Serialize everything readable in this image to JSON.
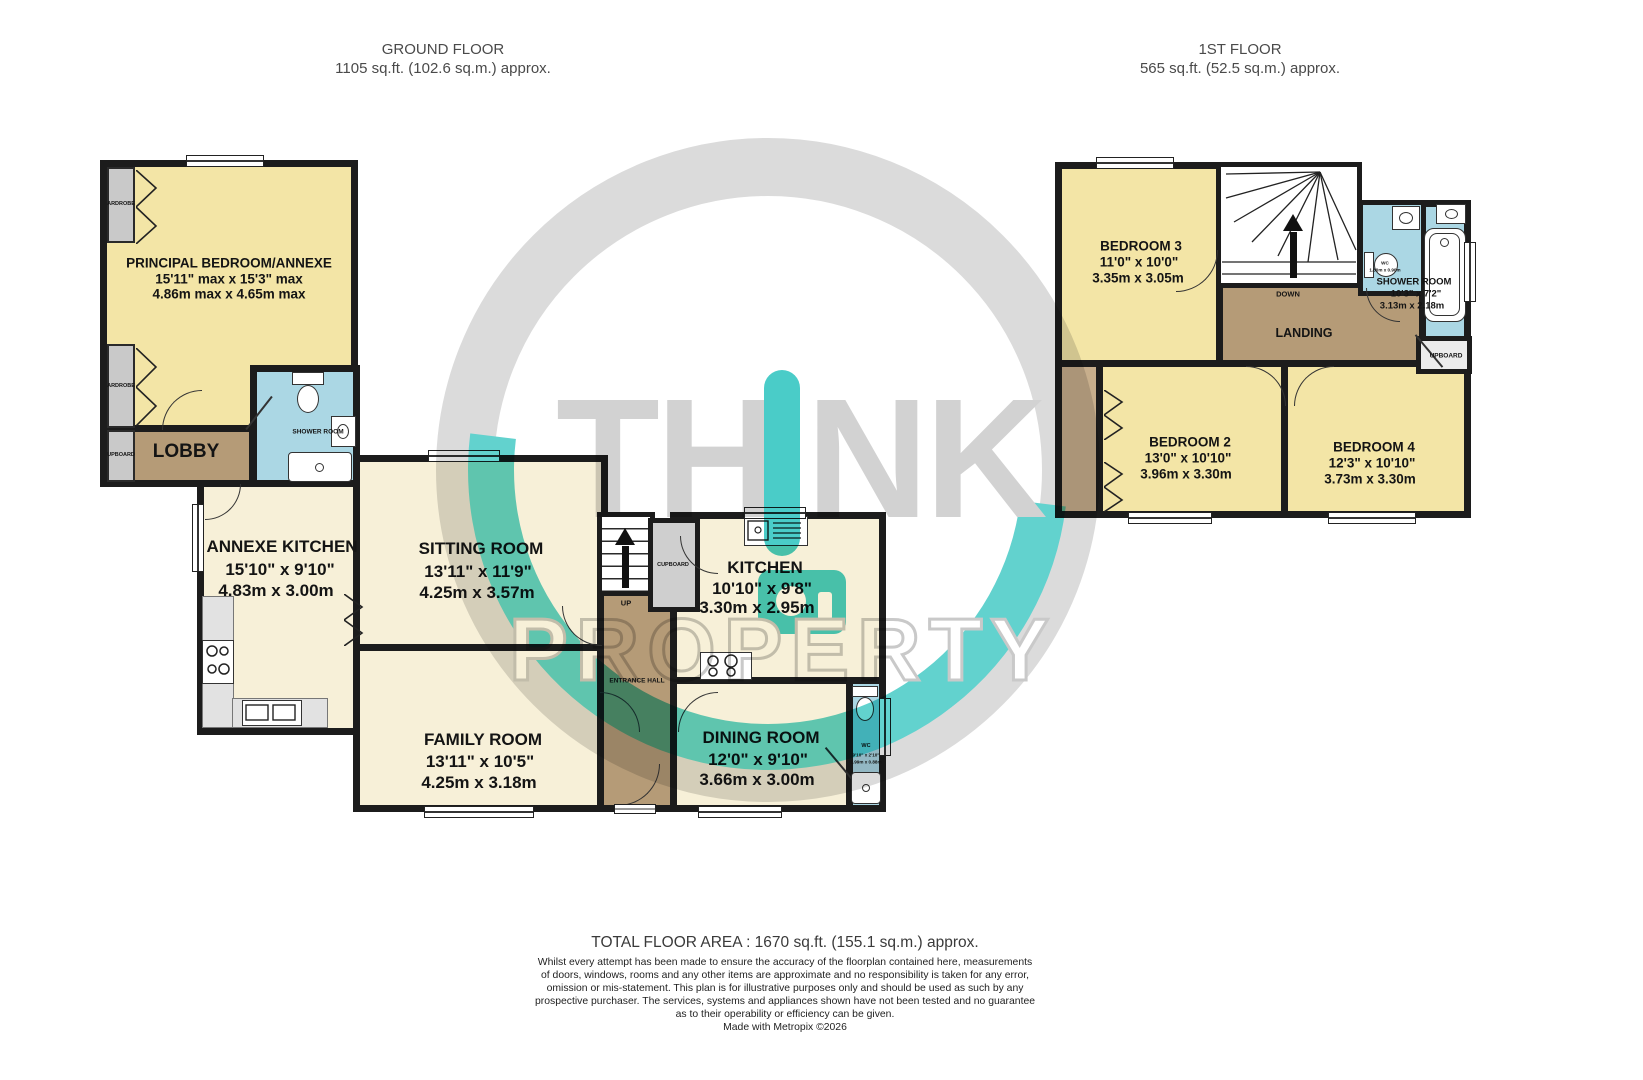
{
  "header": {
    "ground_title": "GROUND FLOOR",
    "ground_area": "1105 sq.ft. (102.6 sq.m.) approx.",
    "first_title": "1ST FLOOR",
    "first_area": "565 sq.ft. (52.5 sq.m.) approx."
  },
  "ground_floor": {
    "principal_bedroom": {
      "name": "PRINCIPAL BEDROOM/ANNEXE",
      "dims_ft": "15'11\" max x 15'3\" max",
      "dims_m": "4.86m max x 4.65m max"
    },
    "lobby": {
      "name": "LOBBY"
    },
    "shower_room": {
      "name": "SHOWER ROOM"
    },
    "annexe_kitchen": {
      "name": "ANNEXE KITCHEN",
      "dims_ft": "15'10\"  x 9'10\"",
      "dims_m": "4.83m  x 3.00m"
    },
    "sitting_room": {
      "name": "SITTING ROOM",
      "dims_ft": "13'11\"  x 11'9\"",
      "dims_m": "4.25m  x 3.57m"
    },
    "family_room": {
      "name": "FAMILY ROOM",
      "dims_ft": "13'11\"  x 10'5\"",
      "dims_m": "4.25m  x 3.18m"
    },
    "kitchen": {
      "name": "KITCHEN",
      "dims_ft": "10'10\"  x 9'8\"",
      "dims_m": "3.30m  x 2.95m"
    },
    "dining_room": {
      "name": "DINING ROOM",
      "dims_ft": "12'0\"  x 9'10\"",
      "dims_m": "3.66m  x 3.00m"
    },
    "wc": {
      "name": "WC",
      "dims_ft": "9'10\" x 2'10\"",
      "dims_m": "2.99m x 0.88m"
    },
    "entrance_hall": {
      "name": "ENTRANCE HALL"
    },
    "cupboard": {
      "name": "CUPBOARD"
    },
    "stairs": {
      "label": "UP"
    },
    "wardrobe_top": {
      "name": "ARDROBE"
    },
    "wardrobe_bottom": {
      "name": "ARDROBE"
    },
    "cupboard_left": {
      "name": "UPBOARD"
    }
  },
  "first_floor": {
    "bedroom3": {
      "name": "BEDROOM 3",
      "dims_ft": "11'0\"  x 10'0\"",
      "dims_m": "3.35m  x 3.05m"
    },
    "bedroom2": {
      "name": "BEDROOM 2",
      "dims_ft": "13'0\"  x 10'10\"",
      "dims_m": "3.96m  x 3.30m"
    },
    "bedroom4": {
      "name": "BEDROOM 4",
      "dims_ft": "12'3\"  x 10'10\"",
      "dims_m": "3.73m  x 3.30m"
    },
    "landing": {
      "name": "LANDING"
    },
    "shower_room": {
      "name": "SHOWER ROOM",
      "dims_ft": "10'3\"  x 7'2\"",
      "dims_m": "3.13m  x 2.18m"
    },
    "wc": {
      "name": "WC",
      "dims_m": "1.80m x 0.90m"
    },
    "stairs": {
      "label": "DOWN"
    },
    "cupboard": {
      "name": "UPBOARD"
    }
  },
  "watermark": {
    "word_part1": "TH",
    "word_part2": "NK",
    "word2": "PROPERTY",
    "accent_color": "#4ACCC8",
    "gray_color": "#D2D2D2"
  },
  "footer": {
    "total_area": "TOTAL FLOOR AREA : 1670 sq.ft. (155.1 sq.m.) approx.",
    "disclaimer": [
      "Whilst every attempt has been made to ensure the accuracy of the floorplan contained here, measurements",
      "of doors, windows, rooms and any other items are approximate and no responsibility is taken for any error,",
      "omission or mis-statement. This plan is for illustrative purposes only and should be used as such by any",
      "prospective purchaser. The services, systems and appliances shown have not been tested and no guarantee",
      "as to their operability or efficiency can be given."
    ],
    "credit": "Made with Metropix ©2026"
  },
  "colors": {
    "room_yellow": "#F3E5A6",
    "room_cream": "#F7F0D8",
    "hall_brown": "#B59B77",
    "bath_blue": "#ABD7E4",
    "wall": "#1C1C1C",
    "fixture_gray": "#C9C9C9"
  }
}
